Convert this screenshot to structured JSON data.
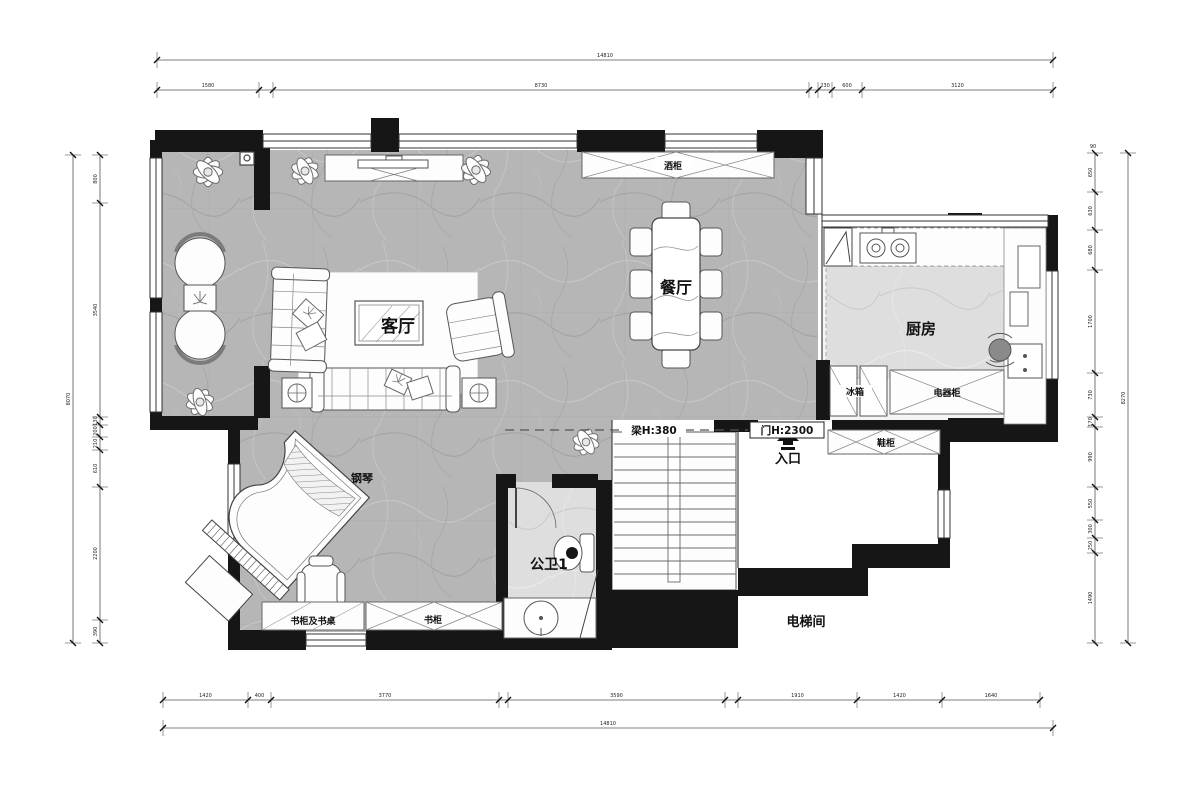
{
  "plan_type": "floor-plan",
  "labels": {
    "living": "客厅",
    "dining": "餐厅",
    "kitchen": "厨房",
    "bath": "公卫1",
    "entry": "入口",
    "elevator": "电梯间",
    "piano": "钢琴",
    "wine_cabinet": "酒柜",
    "fridge": "冰箱",
    "appliance_cabinet": "电器柜",
    "shoe_cabinet": "鞋柜",
    "desk_bookcase": "书柜及书桌",
    "bookcase": "书柜",
    "beam": "梁H:380",
    "door_height": "门H:2300"
  },
  "colors": {
    "wall": "#161616",
    "line": "#4a4a4a",
    "floor_marble": "#b6b6b6",
    "floor_light": "#dedede",
    "background": "#ffffff"
  },
  "dimensions": {
    "top_total": "14810",
    "top_segments": [
      "1580",
      "",
      "8730",
      "",
      "230",
      "600",
      "3120"
    ],
    "bottom_segments": [
      "1420",
      "400",
      "3770",
      "",
      "3590",
      "",
      "1910",
      "1420",
      "1640"
    ],
    "bottom_total": "14810",
    "left_total": "8070",
    "left_segments": [
      "800",
      "3540",
      "130",
      "200",
      "210",
      "610",
      "2200",
      "390"
    ],
    "right_segments": [
      "650",
      "630",
      "680",
      "1700",
      "730",
      "170",
      "990",
      "550",
      "300",
      "250",
      "1490"
    ],
    "right_total": "8270",
    "right_top_extra": "90"
  }
}
